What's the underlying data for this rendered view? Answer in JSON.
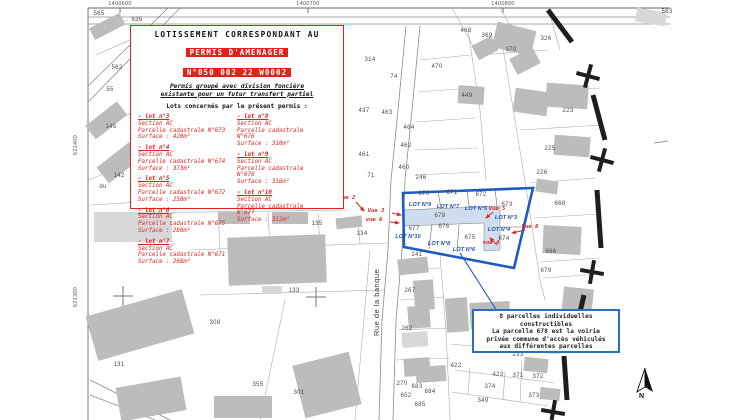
{
  "colors": {
    "red": "#e3211b",
    "blue": "#1d5bbf",
    "blue_light": "#cfdeef",
    "building": "#bcbcbc"
  },
  "coordinates": {
    "top": [
      {
        "label": "1400600",
        "x": 120
      },
      {
        "label": "1400700",
        "x": 308
      },
      {
        "label": "1400800",
        "x": 503
      }
    ],
    "left": [
      {
        "label": "621400",
        "y": 145
      },
      {
        "label": "621300",
        "y": 297
      }
    ]
  },
  "red_box": {
    "title": "LOTISSEMENT CORRESPONDANT AU",
    "permit_line1": "PERMIS D'AMENAGER",
    "permit_line2": "N°050 002 22 W0002",
    "subtitle": "Permis groupé avec division foncière\nexistante pour un futur transfert partiel",
    "intro": "Lots concernés par le présent permis :",
    "columns": [
      [
        {
          "header": "- lot n°3",
          "lines": [
            "Section AC",
            "Parcelle cadastrale N°673",
            "Surface : 420m²"
          ]
        },
        {
          "header": "- lot n°4",
          "lines": [
            "Section AC",
            "Parcelle cadastrale N°674",
            "Surface : 373m²"
          ]
        },
        {
          "header": "- lot n°5",
          "lines": [
            "Section AC",
            "Parcelle cadastrale N°672",
            "Surface : 250m²"
          ]
        },
        {
          "header": "- lot n°6",
          "lines": [
            "Section AC",
            "Parcelle cadastrale N°675",
            "Surface : 280m²"
          ]
        },
        {
          "header": "- lot n°7",
          "lines": [
            "Section AC",
            "Parcelle cadastrale N°671",
            "Surface : 268m²"
          ]
        }
      ],
      [
        {
          "header": "- lot n°8",
          "lines": [
            "Section AC",
            "Parcelle cadastrale",
            "N°676",
            "Surface : 310m²"
          ]
        },
        {
          "header": "- lot n°9",
          "lines": [
            "Section AC",
            "Parcelle cadastrale",
            "N°670",
            "Surface : 316m²"
          ]
        },
        {
          "header": "- lot n°10",
          "lines": [
            "Section AC",
            "Parcelle cadastrale",
            "N°677",
            "Surface : 312m²"
          ]
        }
      ]
    ]
  },
  "info_box": {
    "text": "8 parcelles individuelles\nconstructibles\nLa parcelle 678 est la voirie\nprivée commune d'accès véhiculés\naux différentes parcelles"
  },
  "street": {
    "name": "Rue de la banque"
  },
  "north": {
    "label": "N"
  },
  "blue_zone": {
    "voirie_parcel": "678",
    "parcel_labels": [
      {
        "t": "670",
        "x": 424,
        "y": 194
      },
      {
        "t": "671",
        "x": 452,
        "y": 193
      },
      {
        "t": "672",
        "x": 481,
        "y": 195
      },
      {
        "t": "673",
        "x": 507,
        "y": 205
      },
      {
        "t": "678",
        "x": 440,
        "y": 216
      },
      {
        "t": "677",
        "x": 414,
        "y": 229
      },
      {
        "t": "676",
        "x": 444,
        "y": 227
      },
      {
        "t": "675",
        "x": 470,
        "y": 238
      },
      {
        "t": "674",
        "x": 504,
        "y": 239
      }
    ],
    "lot_labels": [
      {
        "t": "LOT N°9",
        "x": 420,
        "y": 205
      },
      {
        "t": "LOT N°7",
        "x": 448,
        "y": 207
      },
      {
        "t": "LOT N°5",
        "x": 476,
        "y": 209
      },
      {
        "t": "LOT N°3",
        "x": 506,
        "y": 218
      },
      {
        "t": "LOT N°10",
        "x": 408,
        "y": 237
      },
      {
        "t": "LOT N°8",
        "x": 439,
        "y": 244
      },
      {
        "t": "LOT N°6",
        "x": 464,
        "y": 250
      },
      {
        "t": "LOT N°4",
        "x": 499,
        "y": 230
      }
    ]
  },
  "vue_labels": [
    {
      "t": "Vue 2",
      "x": 347,
      "y": 198
    },
    {
      "t": "Vue 3",
      "x": 376,
      "y": 211
    },
    {
      "t": "vue 6",
      "x": 374,
      "y": 220
    },
    {
      "t": "Vue 5",
      "x": 497,
      "y": 209
    },
    {
      "t": "Vue 8",
      "x": 530,
      "y": 227
    },
    {
      "t": "vue 4",
      "x": 491,
      "y": 243
    }
  ],
  "parcel_labels": [
    {
      "t": "565",
      "x": 99,
      "y": 14
    },
    {
      "t": "635",
      "x": 137,
      "y": 20
    },
    {
      "t": "562",
      "x": 117,
      "y": 68
    },
    {
      "t": "55",
      "x": 110,
      "y": 90
    },
    {
      "t": "145",
      "x": 111,
      "y": 127
    },
    {
      "t": "142",
      "x": 119,
      "y": 176
    },
    {
      "t": "du",
      "x": 103,
      "y": 187
    },
    {
      "t": "131",
      "x": 119,
      "y": 365
    },
    {
      "t": "308",
      "x": 215,
      "y": 323
    },
    {
      "t": "133",
      "x": 294,
      "y": 291
    },
    {
      "t": "355",
      "x": 258,
      "y": 385
    },
    {
      "t": "301",
      "x": 299,
      "y": 393
    },
    {
      "t": "135",
      "x": 317,
      "y": 224
    },
    {
      "t": "134",
      "x": 362,
      "y": 234
    },
    {
      "t": "241",
      "x": 417,
      "y": 255
    },
    {
      "t": "267",
      "x": 410,
      "y": 291
    },
    {
      "t": "262",
      "x": 407,
      "y": 329
    },
    {
      "t": "270",
      "x": 402,
      "y": 384
    },
    {
      "t": "602",
      "x": 406,
      "y": 396
    },
    {
      "t": "683",
      "x": 417,
      "y": 387
    },
    {
      "t": "684",
      "x": 430,
      "y": 392
    },
    {
      "t": "685",
      "x": 420,
      "y": 405
    },
    {
      "t": "422",
      "x": 456,
      "y": 366
    },
    {
      "t": "423",
      "x": 498,
      "y": 375
    },
    {
      "t": "371",
      "x": 518,
      "y": 376
    },
    {
      "t": "372",
      "x": 538,
      "y": 377
    },
    {
      "t": "374",
      "x": 490,
      "y": 387
    },
    {
      "t": "373",
      "x": 534,
      "y": 396
    },
    {
      "t": "349",
      "x": 483,
      "y": 401
    },
    {
      "t": "233",
      "x": 518,
      "y": 355
    },
    {
      "t": "468",
      "x": 466,
      "y": 31
    },
    {
      "t": "369",
      "x": 487,
      "y": 36
    },
    {
      "t": "326",
      "x": 546,
      "y": 39
    },
    {
      "t": "370",
      "x": 511,
      "y": 50
    },
    {
      "t": "563",
      "x": 667,
      "y": 12
    },
    {
      "t": "314",
      "x": 370,
      "y": 60
    },
    {
      "t": "74",
      "x": 394,
      "y": 77
    },
    {
      "t": "437",
      "x": 364,
      "y": 111
    },
    {
      "t": "463",
      "x": 387,
      "y": 113
    },
    {
      "t": "470",
      "x": 437,
      "y": 67
    },
    {
      "t": "449",
      "x": 467,
      "y": 96
    },
    {
      "t": "464",
      "x": 409,
      "y": 128
    },
    {
      "t": "462",
      "x": 406,
      "y": 146
    },
    {
      "t": "461",
      "x": 364,
      "y": 155
    },
    {
      "t": "460",
      "x": 404,
      "y": 168
    },
    {
      "t": "71",
      "x": 371,
      "y": 176
    },
    {
      "t": "246",
      "x": 421,
      "y": 178
    },
    {
      "t": "223",
      "x": 568,
      "y": 111
    },
    {
      "t": "225",
      "x": 550,
      "y": 149
    },
    {
      "t": "226",
      "x": 542,
      "y": 173
    },
    {
      "t": "668",
      "x": 560,
      "y": 204
    },
    {
      "t": "666",
      "x": 551,
      "y": 252
    },
    {
      "t": "679",
      "x": 546,
      "y": 271
    }
  ]
}
